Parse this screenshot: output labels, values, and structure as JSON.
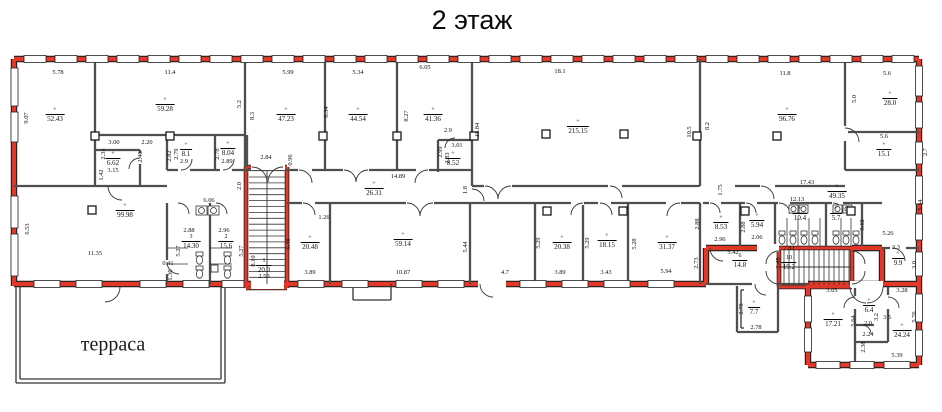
{
  "title": "2 этаж",
  "terrace_label": "терраса",
  "colors": {
    "outline_red": "#e2382a",
    "wall_gray": "#4f4f4f",
    "thin": "#333333",
    "black_edge": "#1c1c1c"
  },
  "area_labels": [
    {
      "n": "+",
      "v": "52.43",
      "x": 55,
      "y": 116
    },
    {
      "n": "+",
      "v": "59.28",
      "x": 165,
      "y": 106
    },
    {
      "n": "+",
      "v": "47.23",
      "x": 286,
      "y": 116
    },
    {
      "n": "+",
      "v": "44.54",
      "x": 358,
      "y": 116
    },
    {
      "n": "+",
      "v": "41.36",
      "x": 433,
      "y": 116
    },
    {
      "n": "+",
      "v": "8.52",
      "x": 453,
      "y": 160
    },
    {
      "n": "+",
      "v": "6.62",
      "x": 113,
      "y": 160
    },
    {
      "n": "+",
      "v": "8.1",
      "x": 186,
      "y": 151
    },
    {
      "n": "+",
      "v": "8.04",
      "x": 228,
      "y": 150
    },
    {
      "n": "+",
      "v": "215.15",
      "x": 578,
      "y": 128
    },
    {
      "n": "+",
      "v": "96.76",
      "x": 787,
      "y": 116
    },
    {
      "n": "+",
      "v": "28.0",
      "x": 890,
      "y": 100
    },
    {
      "n": "+",
      "v": "15.1",
      "x": 884,
      "y": 151
    },
    {
      "n": "+",
      "v": "26.31",
      "x": 374,
      "y": 190
    },
    {
      "n": "+",
      "v": "49.35",
      "x": 837,
      "y": 193
    },
    {
      "n": "+",
      "v": "99.98",
      "x": 125,
      "y": 212
    },
    {
      "n": "+",
      "v": "20.48",
      "x": 310,
      "y": 244
    },
    {
      "n": "+",
      "v": "59.14",
      "x": 403,
      "y": 241
    },
    {
      "n": "+",
      "v": "20.38",
      "x": 562,
      "y": 244
    },
    {
      "n": "+",
      "v": "18.15",
      "x": 607,
      "y": 242
    },
    {
      "n": "+",
      "v": "31.37",
      "x": 667,
      "y": 244
    },
    {
      "n": "+",
      "v": "8.53",
      "x": 721,
      "y": 224
    },
    {
      "n": "+",
      "v": "5.94",
      "x": 757,
      "y": 222
    },
    {
      "n": "+",
      "v": "10.4",
      "x": 800,
      "y": 215
    },
    {
      "n": "+",
      "v": "5.7",
      "x": 836,
      "y": 215
    },
    {
      "n": "3",
      "v": "14.30",
      "x": 191,
      "y": 243
    },
    {
      "n": "2",
      "v": "15.6",
      "x": 226,
      "y": 243
    },
    {
      "n": "1",
      "v": "20.3",
      "x": 264,
      "y": 267
    },
    {
      "n": "10",
      "v": "19.2",
      "x": 789,
      "y": 264
    },
    {
      "n": "6",
      "v": "14.8",
      "x": 740,
      "y": 262
    },
    {
      "n": "+",
      "v": "9.9",
      "x": 898,
      "y": 260
    },
    {
      "n": "+",
      "v": "7.7",
      "x": 754,
      "y": 309
    },
    {
      "n": "+",
      "v": "17.21",
      "x": 833,
      "y": 321
    },
    {
      "n": "+",
      "v": "6.4",
      "x": 869,
      "y": 307
    },
    {
      "n": "+",
      "v": "24.24",
      "x": 902,
      "y": 332
    }
  ],
  "dimension_labels": [
    {
      "t": "5.78",
      "x": 58,
      "y": 73
    },
    {
      "t": "9.07",
      "x": 27,
      "y": 118,
      "v": 1
    },
    {
      "t": "11.4",
      "x": 170,
      "y": 73
    },
    {
      "t": "5.2",
      "x": 240,
      "y": 104,
      "v": 1
    },
    {
      "t": "5.99",
      "x": 288,
      "y": 73
    },
    {
      "t": "8.3",
      "x": 253,
      "y": 116,
      "v": 1
    },
    {
      "t": "8.34",
      "x": 327,
      "y": 112,
      "v": 1
    },
    {
      "t": "5.34",
      "x": 358,
      "y": 73
    },
    {
      "t": "8.27",
      "x": 407,
      "y": 116,
      "v": 1
    },
    {
      "t": "6.05",
      "x": 425,
      "y": 68
    },
    {
      "t": "2.9",
      "x": 448,
      "y": 131
    },
    {
      "t": "3.01",
      "x": 457,
      "y": 146
    },
    {
      "t": "2.99",
      "x": 441,
      "y": 152,
      "v": 1
    },
    {
      "t": "2.83",
      "x": 448,
      "y": 158,
      "v": 1
    },
    {
      "t": "15.84",
      "x": 478,
      "y": 130,
      "v": 1
    },
    {
      "t": "18.1",
      "x": 560,
      "y": 72
    },
    {
      "t": "10.5",
      "x": 690,
      "y": 132,
      "v": 1
    },
    {
      "t": "8.2",
      "x": 708,
      "y": 126,
      "v": 1
    },
    {
      "t": "11.8",
      "x": 785,
      "y": 74
    },
    {
      "t": "5.6",
      "x": 887,
      "y": 74
    },
    {
      "t": "5.0",
      "x": 855,
      "y": 99,
      "v": 1
    },
    {
      "t": "5.6",
      "x": 884,
      "y": 137
    },
    {
      "t": "2.7",
      "x": 926,
      "y": 152,
      "v": 1
    },
    {
      "t": "5.34",
      "x": 921,
      "y": 205,
      "v": 1
    },
    {
      "t": "3.00",
      "x": 114,
      "y": 143
    },
    {
      "t": "2.20",
      "x": 147,
      "y": 143
    },
    {
      "t": "2.31",
      "x": 104,
      "y": 154,
      "v": 1
    },
    {
      "t": "2.46",
      "x": 141,
      "y": 157,
      "v": 1
    },
    {
      "t": "3.15",
      "x": 113,
      "y": 171
    },
    {
      "t": "1.42",
      "x": 102,
      "y": 175,
      "v": 1
    },
    {
      "t": "2.82",
      "x": 170,
      "y": 156,
      "v": 1
    },
    {
      "t": "2.79",
      "x": 177,
      "y": 154,
      "v": 1
    },
    {
      "t": "2.9",
      "x": 184,
      "y": 162
    },
    {
      "t": "2.78",
      "x": 218,
      "y": 154,
      "v": 1
    },
    {
      "t": "2.89",
      "x": 227,
      "y": 162
    },
    {
      "t": "2.84",
      "x": 266,
      "y": 158
    },
    {
      "t": "0.96",
      "x": 291,
      "y": 160,
      "v": 1
    },
    {
      "t": "2.0",
      "x": 240,
      "y": 186,
      "v": 1
    },
    {
      "t": "14.89",
      "x": 398,
      "y": 177
    },
    {
      "t": "1.8",
      "x": 466,
      "y": 190,
      "v": 1
    },
    {
      "t": "17.43",
      "x": 807,
      "y": 183
    },
    {
      "t": "12.13",
      "x": 797,
      "y": 200
    },
    {
      "t": "3.12",
      "x": 863,
      "y": 225,
      "v": 1
    },
    {
      "t": "5.26",
      "x": 888,
      "y": 234
    },
    {
      "t": "6.53",
      "x": 28,
      "y": 229,
      "v": 1
    },
    {
      "t": "11.35",
      "x": 95,
      "y": 254
    },
    {
      "t": "6.06",
      "x": 209,
      "y": 201
    },
    {
      "t": "2.88",
      "x": 189,
      "y": 231
    },
    {
      "t": "2.96",
      "x": 224,
      "y": 231
    },
    {
      "t": "5.27",
      "x": 179,
      "y": 251,
      "v": 1
    },
    {
      "t": "5.27",
      "x": 242,
      "y": 251,
      "v": 1
    },
    {
      "t": "0.41",
      "x": 168,
      "y": 264
    },
    {
      "t": "1.36",
      "x": 171,
      "y": 275,
      "v": 1
    },
    {
      "t": "8.10",
      "x": 254,
      "y": 261,
      "v": 1
    },
    {
      "t": "2.50",
      "x": 264,
      "y": 277
    },
    {
      "t": "5.48",
      "x": 289,
      "y": 244,
      "v": 1
    },
    {
      "t": "3.89",
      "x": 310,
      "y": 273
    },
    {
      "t": "1.26",
      "x": 324,
      "y": 218
    },
    {
      "t": "5.44",
      "x": 466,
      "y": 247,
      "v": 1
    },
    {
      "t": "10.87",
      "x": 403,
      "y": 273
    },
    {
      "t": "4.7",
      "x": 505,
      "y": 273
    },
    {
      "t": "5.29",
      "x": 539,
      "y": 243,
      "v": 1
    },
    {
      "t": "3.89",
      "x": 560,
      "y": 273
    },
    {
      "t": "5.29",
      "x": 588,
      "y": 243,
      "v": 1
    },
    {
      "t": "3.43",
      "x": 606,
      "y": 273
    },
    {
      "t": "5.28",
      "x": 635,
      "y": 244,
      "v": 1
    },
    {
      "t": "5.94",
      "x": 666,
      "y": 272
    },
    {
      "t": "2.88",
      "x": 698,
      "y": 224,
      "v": 1
    },
    {
      "t": "2.96",
      "x": 720,
      "y": 240
    },
    {
      "t": "2.88",
      "x": 744,
      "y": 227,
      "v": 1
    },
    {
      "t": "2.06",
      "x": 757,
      "y": 238
    },
    {
      "t": "1.75",
      "x": 721,
      "y": 190,
      "v": 1
    },
    {
      "t": "5.42",
      "x": 733,
      "y": 253
    },
    {
      "t": "2.73",
      "x": 697,
      "y": 263,
      "v": 1
    },
    {
      "t": "7.82",
      "x": 789,
      "y": 249
    },
    {
      "t": "2.45",
      "x": 779,
      "y": 263,
      "v": 1
    },
    {
      "t": "3.3",
      "x": 896,
      "y": 248
    },
    {
      "t": "3.0",
      "x": 915,
      "y": 265,
      "v": 1
    },
    {
      "t": "3.05",
      "x": 832,
      "y": 291
    },
    {
      "t": "3.28",
      "x": 902,
      "y": 291
    },
    {
      "t": "5.64",
      "x": 854,
      "y": 321,
      "v": 1
    },
    {
      "t": "3.2",
      "x": 877,
      "y": 317,
      "v": 1
    },
    {
      "t": "3.5",
      "x": 887,
      "y": 318
    },
    {
      "t": "2.0",
      "x": 868,
      "y": 324
    },
    {
      "t": "2.24",
      "x": 868,
      "y": 335
    },
    {
      "t": "2.38",
      "x": 864,
      "y": 347,
      "v": 1
    },
    {
      "t": "5.76",
      "x": 915,
      "y": 317,
      "v": 1
    },
    {
      "t": "5.39",
      "x": 897,
      "y": 356
    },
    {
      "t": "2.78",
      "x": 742,
      "y": 309,
      "v": 1
    },
    {
      "t": "2.78",
      "x": 756,
      "y": 328
    }
  ]
}
